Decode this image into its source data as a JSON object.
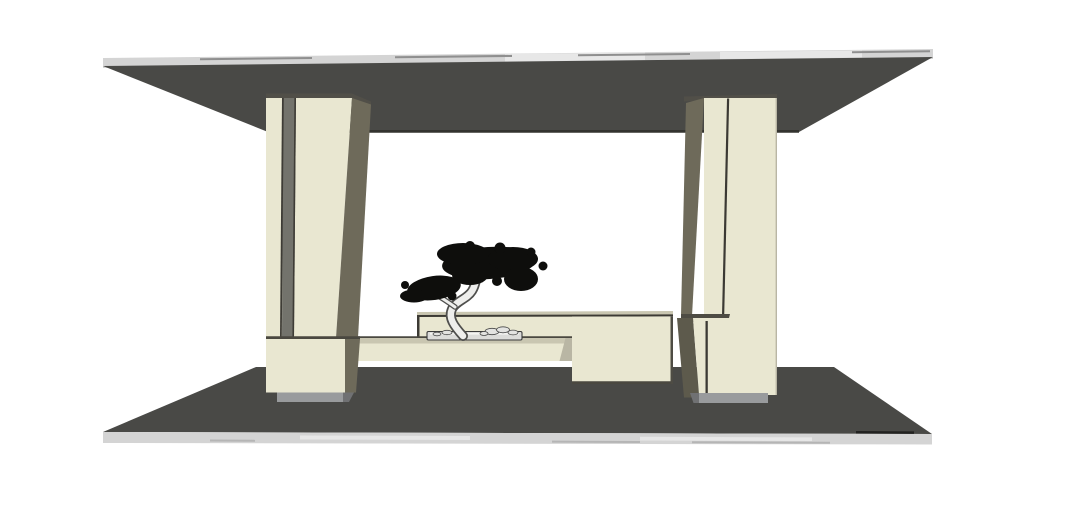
{
  "scene": {
    "type": "3d-render",
    "style": "sketchup-front-elevation",
    "description": "Minimalist wall-unit elevation: two cream cabinet columns spanning between a dark ceiling slab and dark floor slab, a floating bench with back panel between them, and a bonsai tree in a flat stone tray on the bench",
    "objects": {
      "ceiling": "ceiling slab",
      "floor": "floor slab",
      "left_column": "left cabinet column with door gap",
      "right_column": "right cabinet column with door seam",
      "bench": "floating bench with back panel and low cabinet block",
      "bonsai": "bonsai tree",
      "tray": "flat bonsai tray with pebbles"
    }
  },
  "colors": {
    "background": "#ffffff",
    "slab_dark": "#494946",
    "slab_edge_light": "#d4d4d4",
    "slab_edge_bright": "#e7e7e7",
    "slab_edge_seam": "#8f8f8f",
    "slab_bottom_line": "#33332f",
    "floor_seam_line": "#222220",
    "strip_seam": "#b5b5b5",
    "cream": "#e9e7d1",
    "cream_top": "#c9c6b1",
    "cream_edge": "#b9b6a4",
    "olive": "#6e6a5a",
    "olive_dark": "#5d5a4c",
    "stripe": "#73736c",
    "stripe_line": "#3e3c36",
    "cap": "#514f48",
    "ledge": "#4e4c44",
    "seam": "#3c3a34",
    "junction_shadow": "#4a4840",
    "plinth": "#999b9d",
    "plinth_dark": "#707173",
    "tray": "#dcdcda",
    "tray_highlight": "#f4f4f2",
    "rock": "#e3e3e1",
    "rock_line": "#4a4a4a",
    "trunk_fill": "#eeeeec",
    "trunk_line": "#4f4f4d",
    "foliage": "#0e0e0c"
  }
}
